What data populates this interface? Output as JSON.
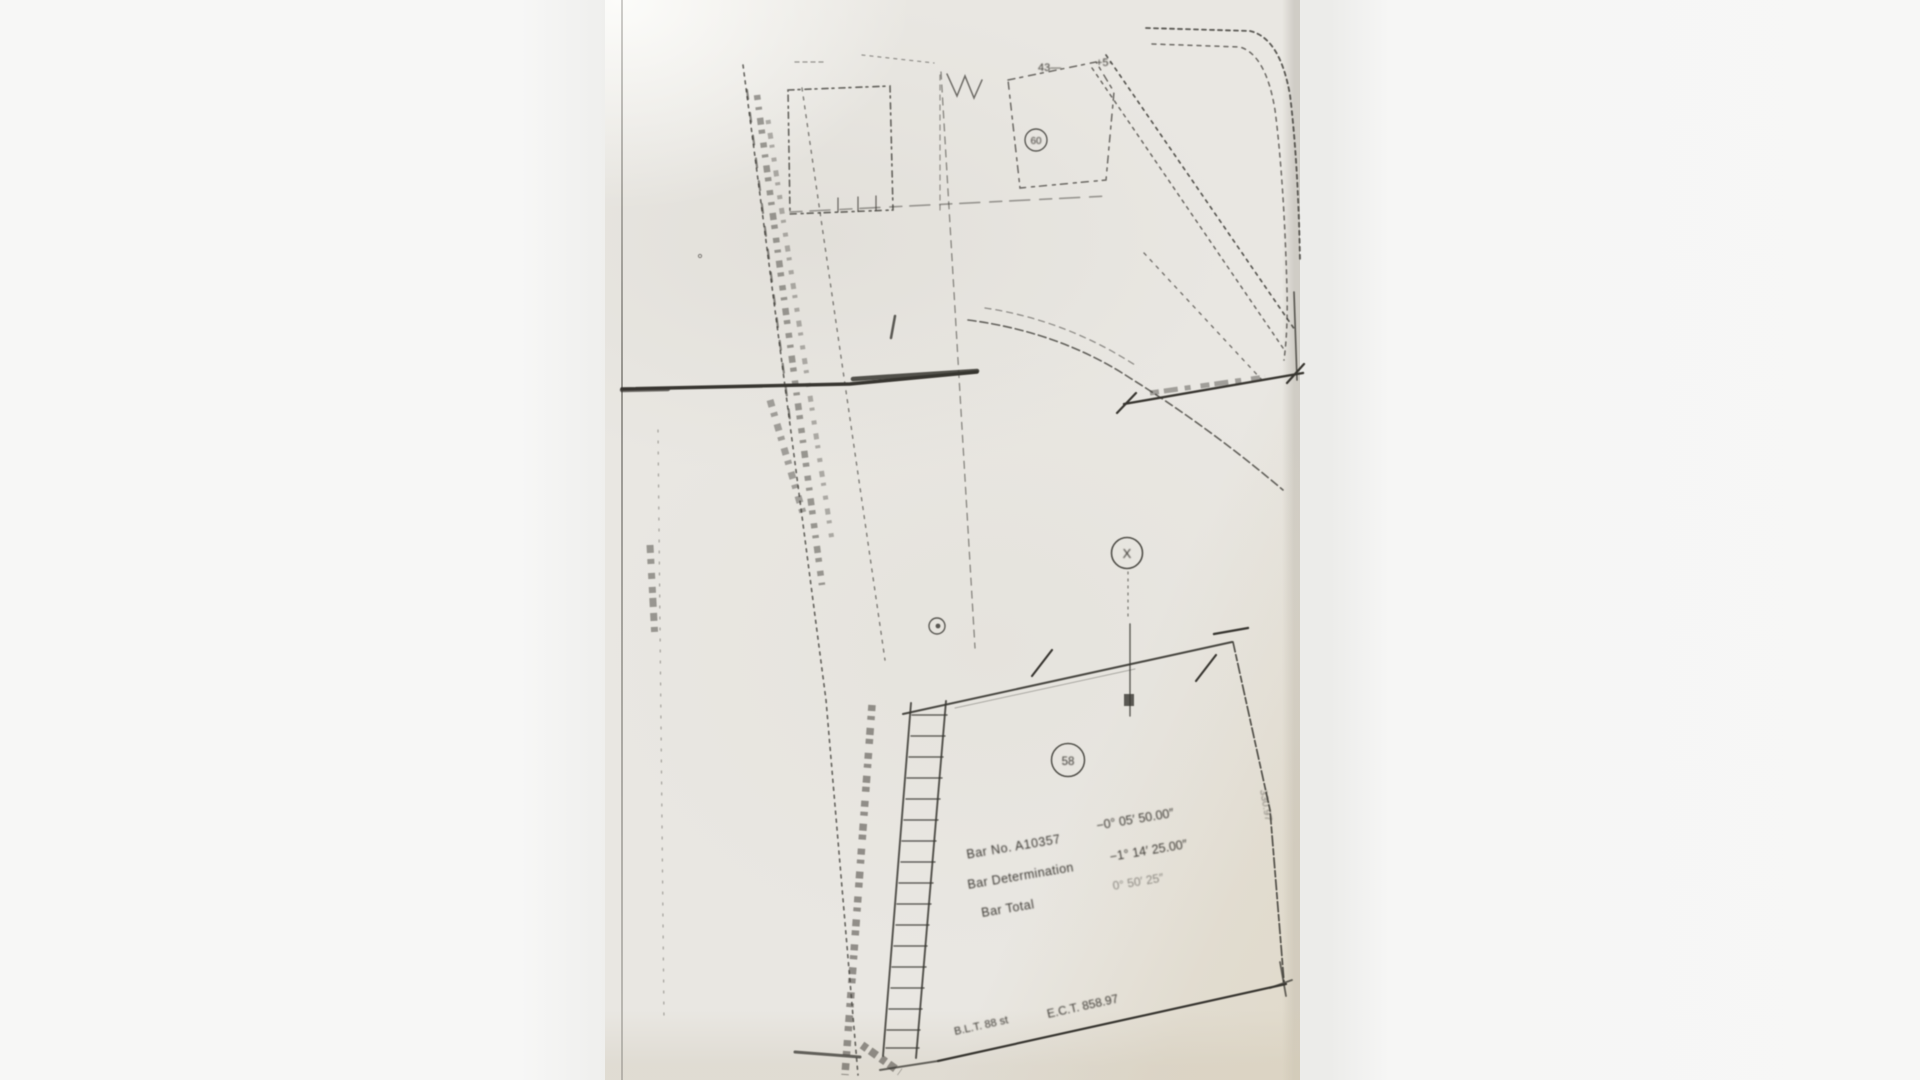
{
  "page": {
    "background_color": "#f5f5f4",
    "paper_color": "#e9e7e2",
    "ink_color": "#3a3833",
    "description": "Scanned hand-drawn survey plat map, low quality photocopy"
  },
  "annotations": {
    "top_left_mark": "43—",
    "top_right_mark": "+5·",
    "tract_badge": "60",
    "station_mark": "X",
    "lot_number": "58",
    "survey_block": {
      "line1_label": "Bar No. A10357",
      "line1_value": "−0° 05′ 50.00″",
      "line2_label": "Bar Determination",
      "line2_value": "−1° 14′ 25.00″",
      "line3_label": "Bar Total",
      "line3_value": "0° 50′ 25″"
    },
    "bottom_left_dim": "B.L.T. 88 st",
    "bottom_dim": "E.C.T. 858.97",
    "right_edge_dim": "330.97"
  }
}
